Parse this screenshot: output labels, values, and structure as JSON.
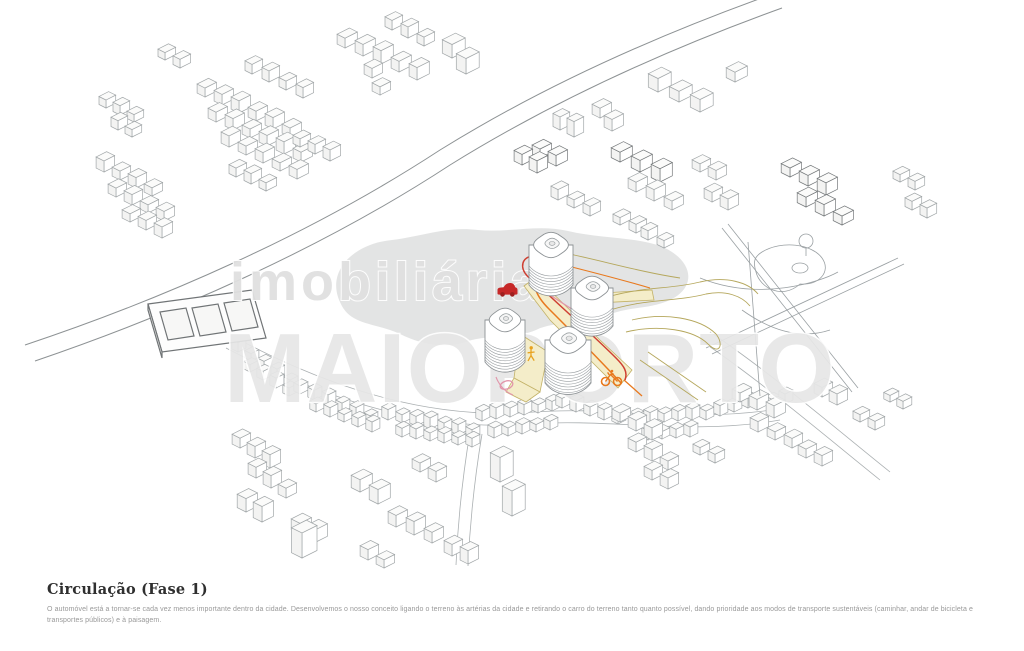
{
  "caption": {
    "title": "Circulação (Fase 1)",
    "body": "O automóvel está a tornar-se cada vez menos importante dentro da cidade. Desenvolvemos o nosso conceito ligando o terreno às artérias da cidade e retirando o carro do terreno tanto quanto possível, dando prioridade aos modos de transporte sustentáveis (caminhar, andar de bicicleta e transportes públicos) e à paisagem."
  },
  "watermark": {
    "line1": "imobiliária",
    "line2": "MAIOPORTO"
  },
  "diagram": {
    "icons": [
      {
        "name": "car-icon",
        "color": "#c62828"
      },
      {
        "name": "bicycle-icon",
        "color": "#e8791e"
      },
      {
        "name": "pedestrian-icon",
        "color": "#e8a21e"
      }
    ],
    "colors": {
      "car_route": "#cf4033",
      "bike_route": "#e8791e",
      "pedestrian_path_fill": "#f4edc9",
      "pedestrian_path_stroke": "#c3b267",
      "secondary_route": "#e295aa",
      "linework": "#a2a7a9",
      "landscape": "#dcdddd"
    }
  }
}
